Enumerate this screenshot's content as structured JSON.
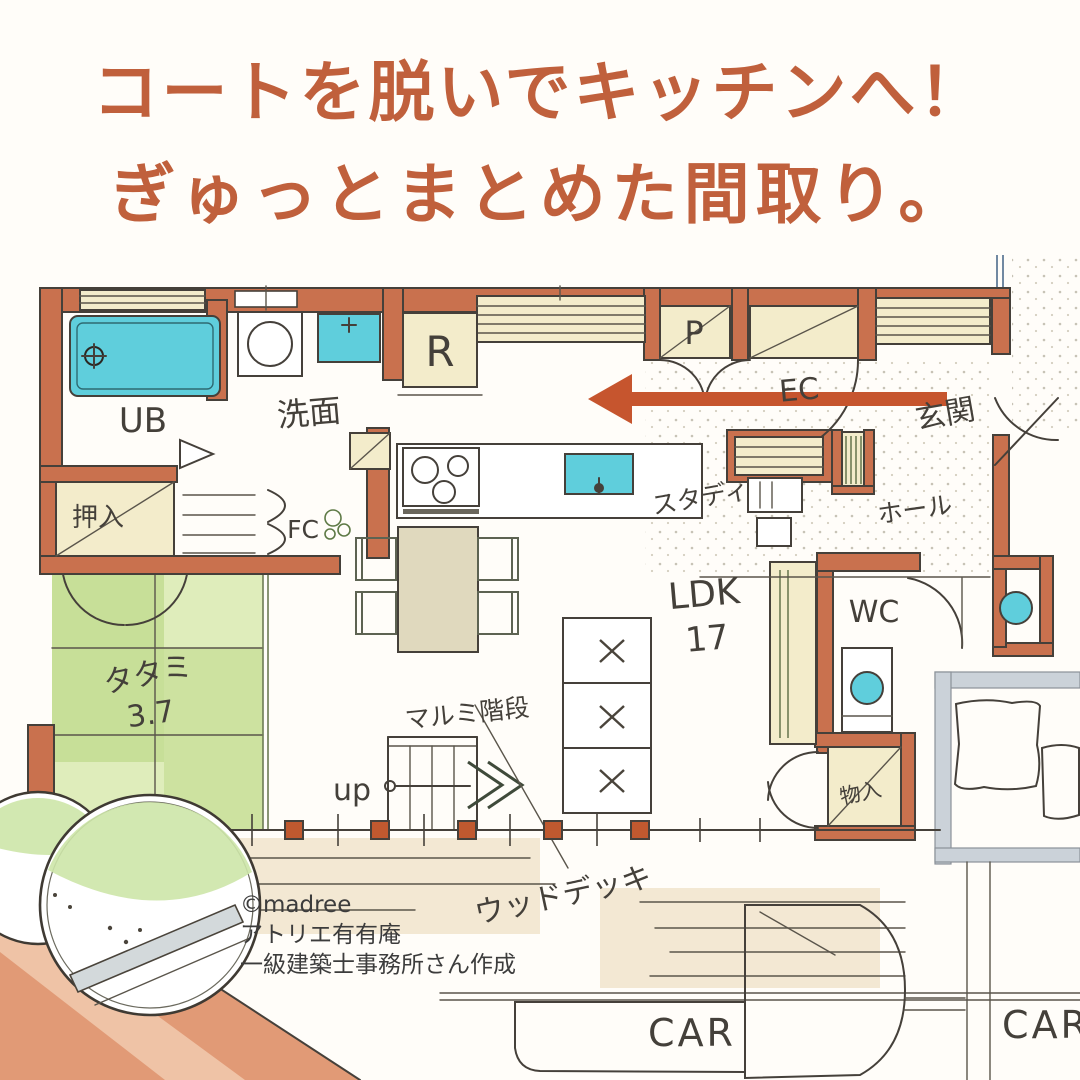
{
  "title": {
    "line1": "コートを脱いでキッチンへ！",
    "line2": "ぎゅっとまとめた間取り。"
  },
  "credit": {
    "line1": "©madree",
    "line2": "アトリエ有有庵",
    "line3": "一級建築士事務所さん作成"
  },
  "rooms": {
    "bath": "UB",
    "washroom": "洗面",
    "fridge": "R",
    "pantry": "P",
    "entrance_closet": "EC",
    "entrance": "玄関",
    "study": "スタディ",
    "hall": "ホール",
    "toilet": "WC",
    "living": "LDK",
    "living_size": "17",
    "tatami": "タタミ",
    "tatami_size": "3.7",
    "closet_upper": "押入",
    "closet_lower": "物入",
    "family_closet": "FC"
  },
  "annotations": {
    "stairs_up": "up",
    "stairs_name": "マルミ階段",
    "wood_deck": "ウッドデッキ",
    "car_left": "CAR",
    "car_right": "CAR"
  },
  "colors": {
    "title_text": "#c0603c",
    "arrow": "#c6552e",
    "wall": "#c9714e",
    "water": "#5fcedc",
    "tatami_green": "#c3dc92",
    "road": "#e19a76",
    "path_gray": "#cbd2d9",
    "window_cream": "#f3eccb",
    "furniture_beige": "#e0d9be",
    "line": "#45403a"
  }
}
